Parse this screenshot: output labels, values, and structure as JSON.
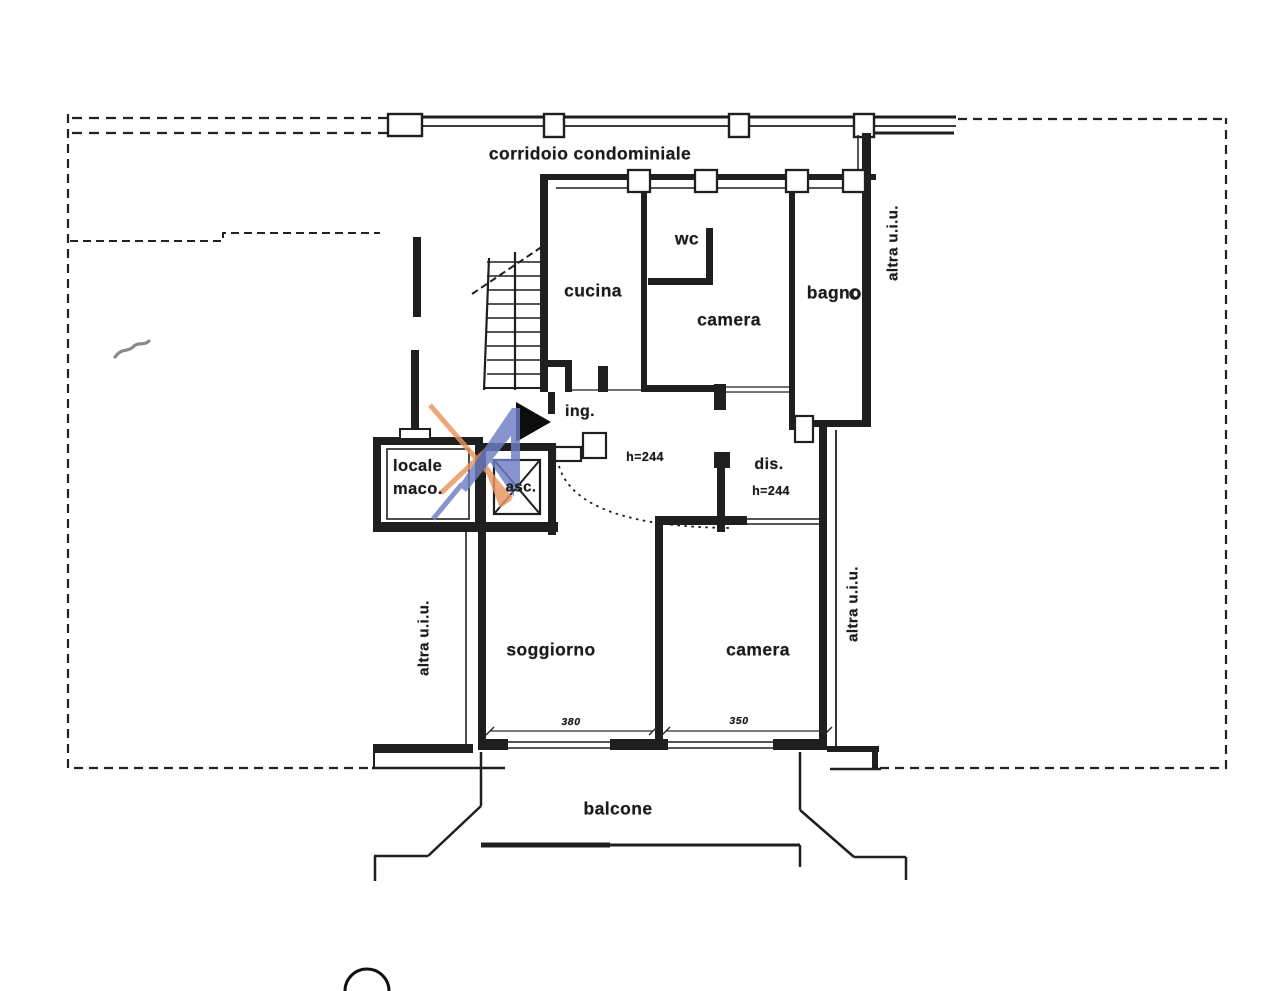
{
  "labels": {
    "corridor": "corridoio condominiale",
    "cucina": "cucina",
    "wc": "wc",
    "camera_top": "camera",
    "bagno": "bagno",
    "ingresso": "ing.",
    "disimpegno": "dis.",
    "locale_macchine": [
      "locale",
      "maco."
    ],
    "ascensore": "asc.",
    "soggiorno": "soggiorno",
    "camera_bottom": "camera",
    "balcone": "balcone"
  },
  "annotations": {
    "ingresso_height": "h=244",
    "disimpegno_height": "h=244",
    "soggiorno_width": "380",
    "camera_width": "350",
    "other_unit_top_right": "altra u.i.u.",
    "other_unit_left": "altra u.i.u.",
    "other_unit_bottom_right": "altra u.i.u."
  },
  "colors": {
    "line": "#1f1f1f",
    "watermark_blue": "#6f7dc3",
    "watermark_orange": "#e8965e"
  }
}
